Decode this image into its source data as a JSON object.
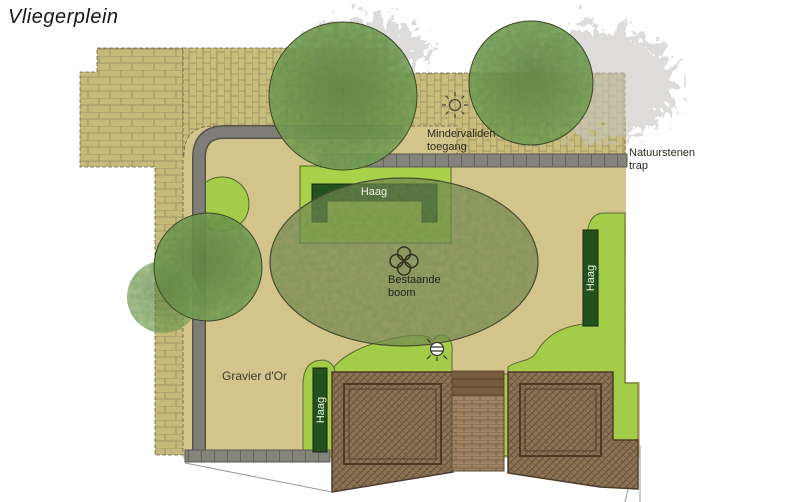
{
  "title": "Vliegerplein",
  "labels": {
    "access_line1": "Mindervaliden",
    "access_line2": "toegang",
    "stairs_line1": "Natuurstenen",
    "stairs_line2": "trap",
    "hedge_top": "Haag",
    "hedge_right": "Haag",
    "hedge_left": "Haag",
    "tree_line1": "Bestaande",
    "tree_line2": "boom",
    "gravel": "Gravier d'Or"
  },
  "colors": {
    "sand": "#d9cb8f",
    "grass": "#a3cd49",
    "hedge_dark": "#24521f",
    "brick": "#c8bc7b",
    "path_gray": "#7f7e76",
    "deck_brown": "#8d7254",
    "foliage_green": "#6f9b4a",
    "existing_tree_olive": "#75834f"
  }
}
